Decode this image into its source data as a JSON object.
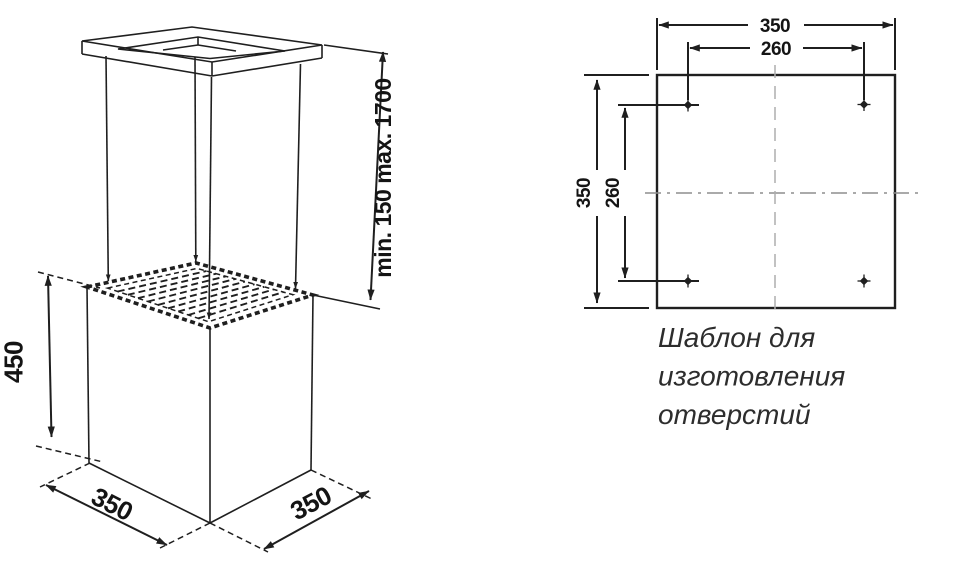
{
  "page": {
    "background": "#ffffff",
    "line_color": "#1f1f1f",
    "centerline_color": "#8e8e8e",
    "caption_color": "#2d2d2d"
  },
  "hood_drawing": {
    "height_label": "450",
    "base_width_label": "350",
    "base_depth_label": "350",
    "chimney_range_label": "min. 150 max. 1700"
  },
  "template_drawing": {
    "outer_width_label": "350",
    "hole_pitch_width_label": "260",
    "outer_height_label": "350",
    "hole_pitch_height_label": "260",
    "caption_lines": [
      "Шаблон для",
      "изготовления",
      "отверстий"
    ]
  }
}
